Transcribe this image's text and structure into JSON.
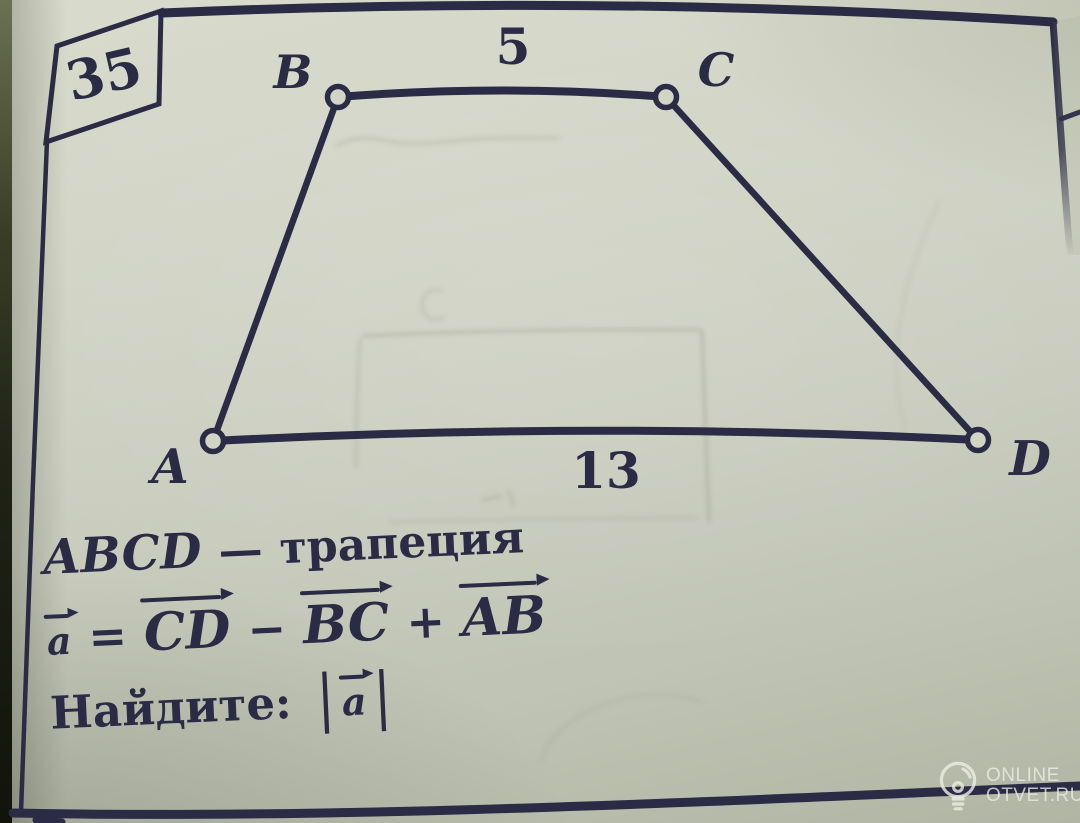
{
  "problem": {
    "number": "35",
    "statement": {
      "figure": "ABCD",
      "dash": "—",
      "word": "трапеция"
    },
    "formula": {
      "lhs": "a",
      "eq": "=",
      "term1": "CD",
      "minus": "−",
      "term2": "BC",
      "plus": "+",
      "term3": "AB"
    },
    "question": {
      "label": "Найдите:",
      "bar_open": "|",
      "vec": "a",
      "bar_close": "|"
    }
  },
  "diagram": {
    "vertex_a": "A",
    "vertex_b": "B",
    "vertex_c": "C",
    "vertex_d": "D",
    "side_bc_label": "5",
    "side_ad_label": "13"
  },
  "watermark": {
    "site_line1": "ONLINE",
    "site_line2": "OTVET.RU",
    "icon": "lightbulb-icon"
  },
  "colors": {
    "ink": "#2b2b46",
    "paper": "#cfd2c3"
  }
}
